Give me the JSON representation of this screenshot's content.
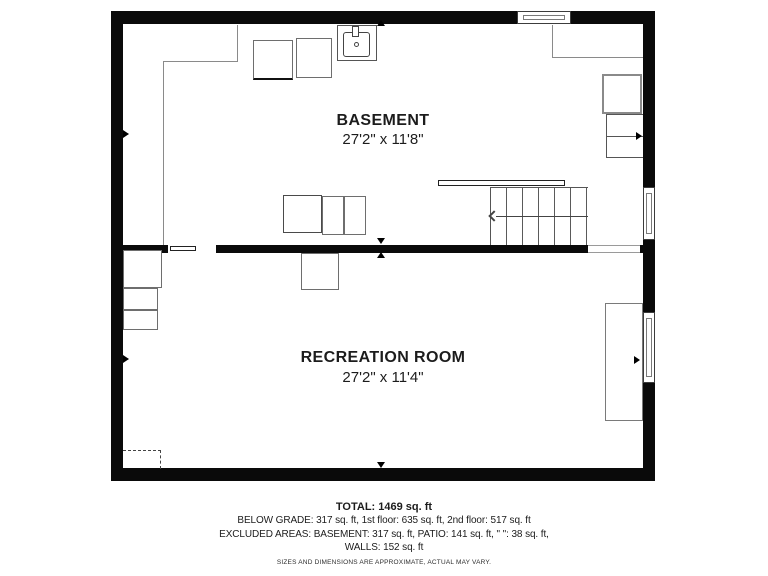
{
  "plan": {
    "title_area": "basement-level-floor-plan",
    "rooms": [
      {
        "name": "BASEMENT",
        "dimensions": "27'2\" x 11'8\""
      },
      {
        "name": "RECREATION ROOM",
        "dimensions": "27'2\" x 11'4\""
      }
    ],
    "footer": {
      "total": "TOTAL: 1469 sq. ft",
      "areas": "BELOW GRADE: 317 sq. ft, 1st floor: 635 sq. ft, 2nd floor: 517 sq. ft",
      "excluded": "EXCLUDED AREAS: BASEMENT: 317 sq. ft, PATIO: 141 sq. ft, \" \": 38 sq. ft,",
      "walls": "WALLS: 152 sq. ft",
      "disclaimer": "SIZES AND DIMENSIONS ARE APPROXIMATE, ACTUAL MAY VARY."
    },
    "icons": [
      "sink-icon",
      "staircase-icon",
      "stair-direction-arrow-icon",
      "wall-marker-icon",
      "window-icon",
      "door-leaf-icon"
    ],
    "colors": {
      "wall": "#0a0a0a",
      "thin_line": "#8a8a8a",
      "fixture_line": "#6e6e6e",
      "text": "#1c1c1c",
      "background": "#ffffff"
    }
  }
}
